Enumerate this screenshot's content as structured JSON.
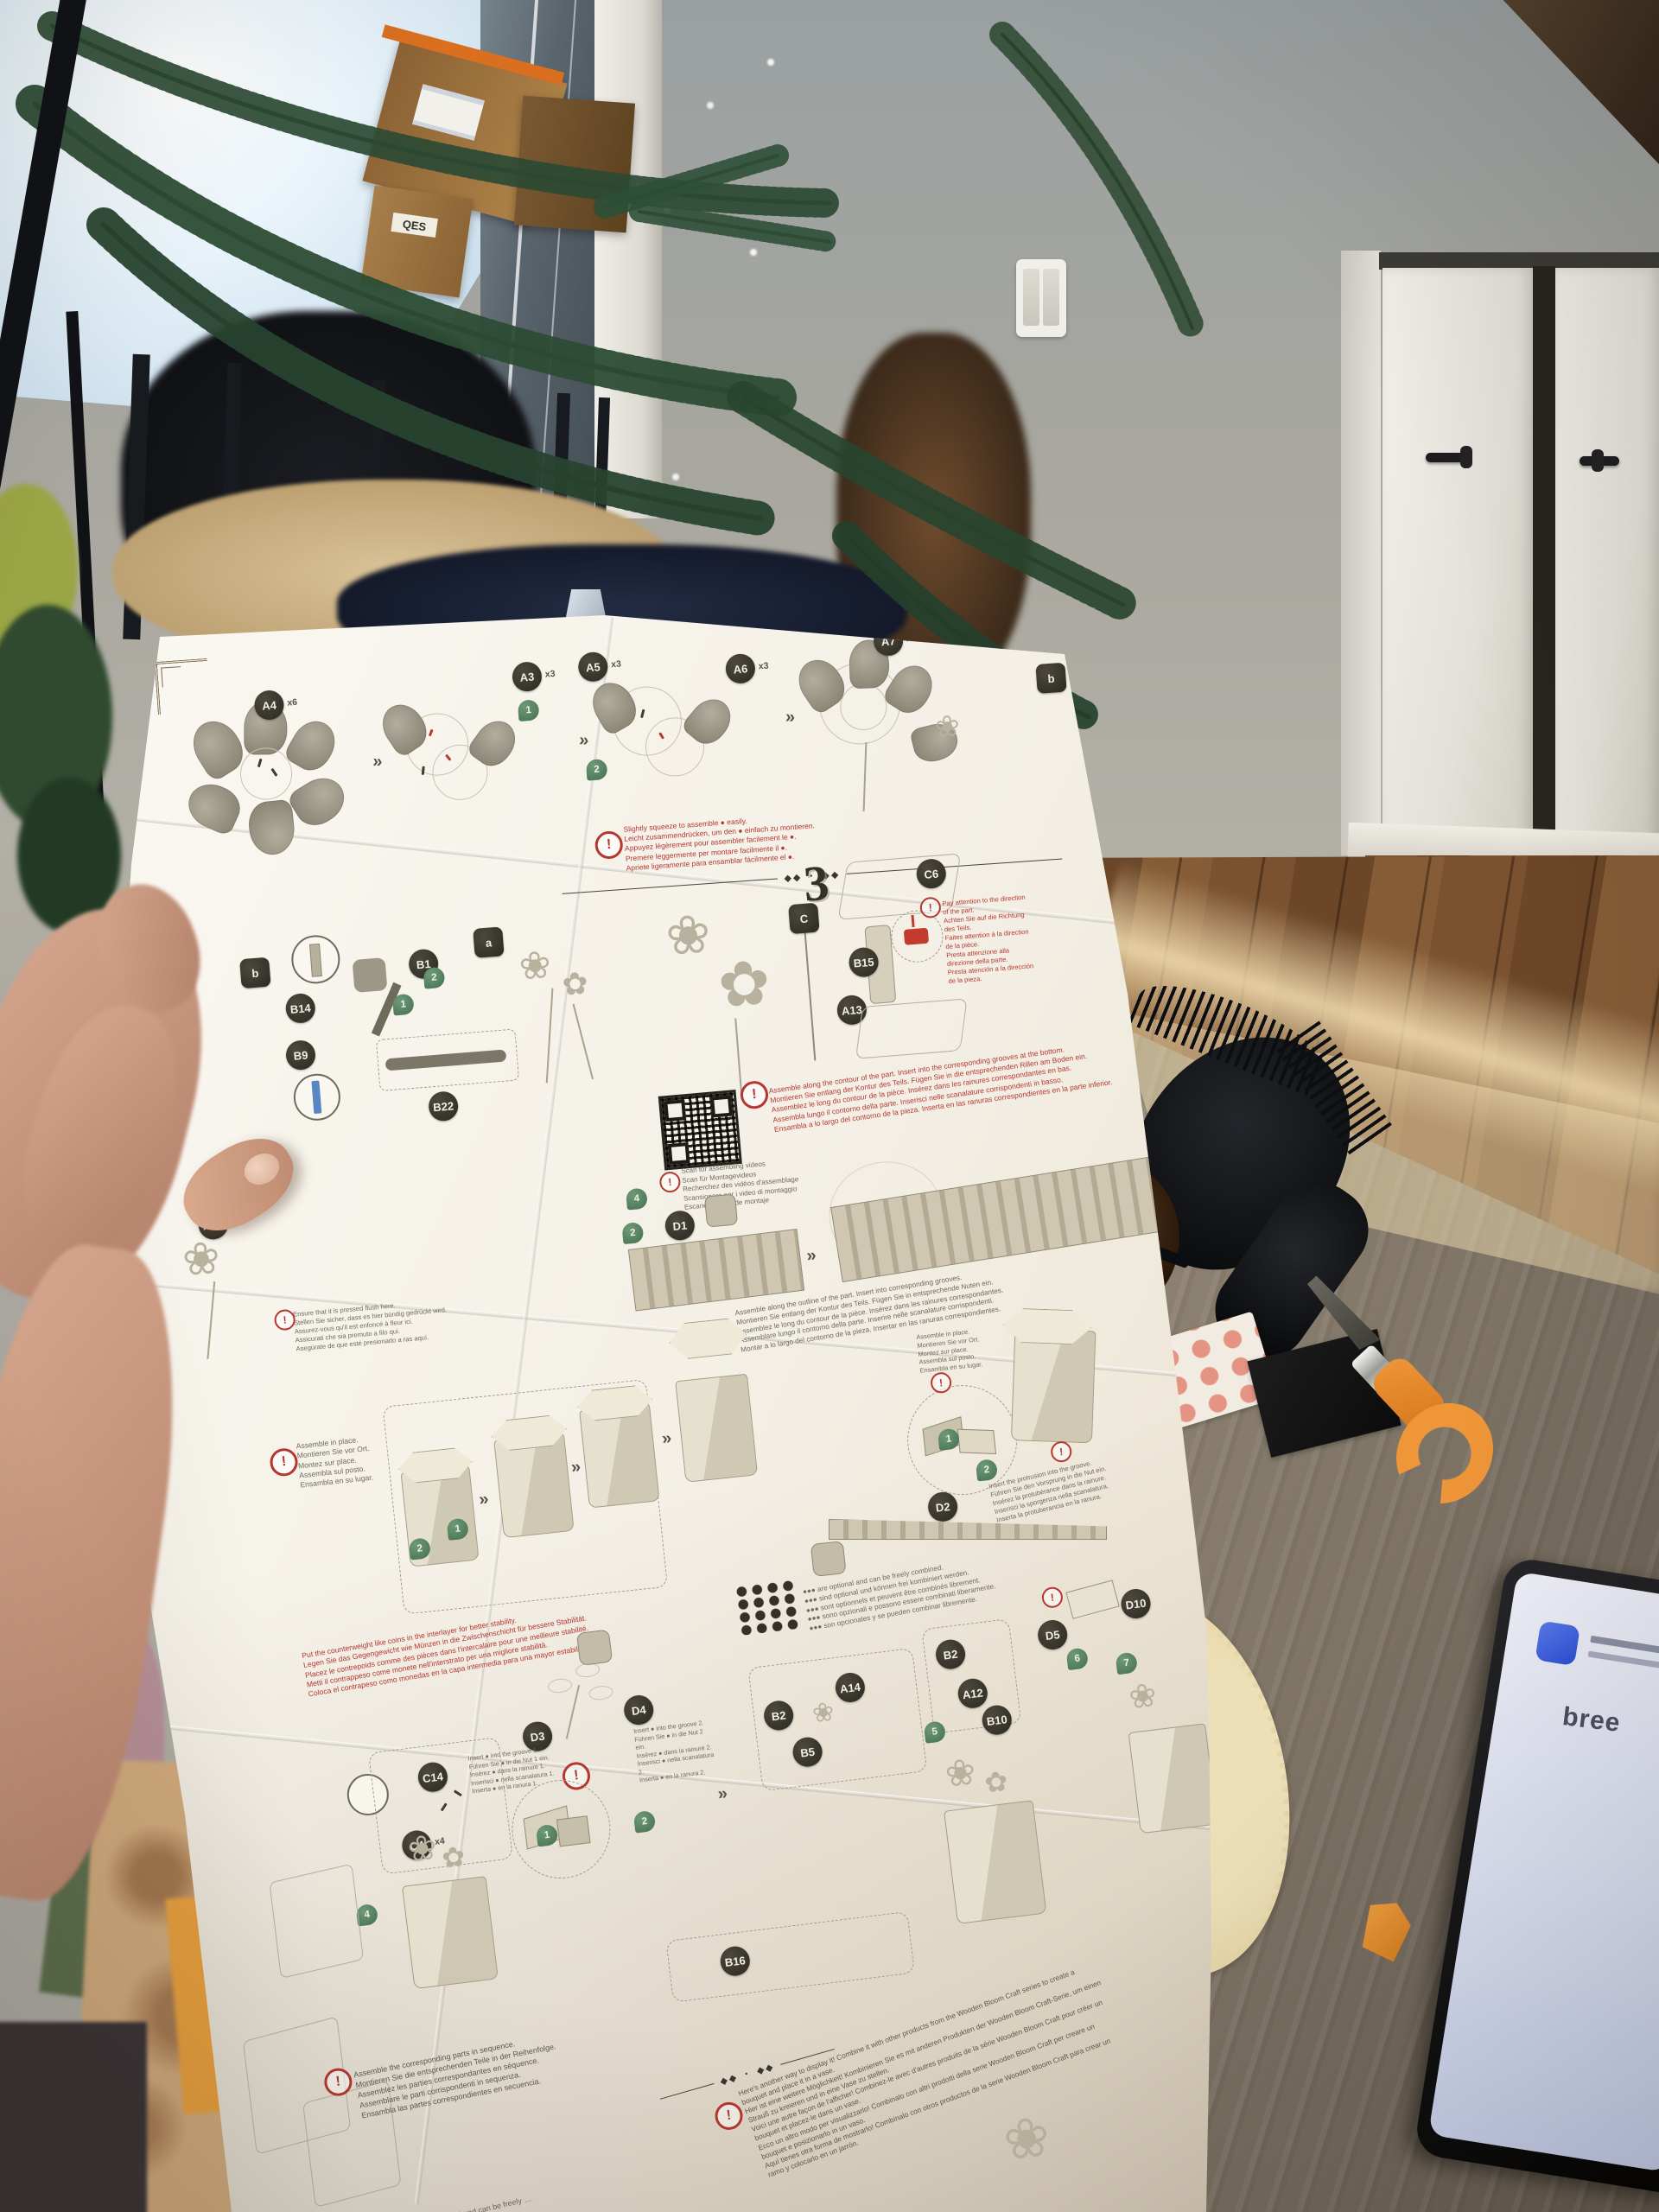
{
  "sheet": {
    "warning_mark": "!",
    "arrow_glyph": "»",
    "divider_glyph": "◆◆ ・ ◆◆",
    "flower_glyph": "❀",
    "flower_glyph2": "✿",
    "row1": {
      "badges": [
        {
          "id": "A4",
          "count": "x6"
        },
        {
          "id": "A3",
          "count": "x3"
        },
        {
          "id": "A5",
          "count": "x3"
        },
        {
          "id": "A6",
          "count": "x3"
        },
        {
          "id": "A7",
          "count": "x3"
        }
      ],
      "letter_badge": "b",
      "steps": [
        "1",
        "2"
      ],
      "warning": [
        "Slightly squeeze to assemble ● easily.",
        "Leicht zusammendrücken, um den ● einfach zu montieren.",
        "Appuyez légèrement pour assembler facilement le ●.",
        "Premere leggermente per montare facilmente il ●.",
        "Apriete ligeramente para ensamblar fácilmente el ●."
      ]
    },
    "row2": {
      "step_number": "3",
      "badges": [
        "b",
        "B14",
        "B9",
        "B1",
        "B22"
      ],
      "letter_a": "a",
      "letter_c": "C",
      "right_badges": [
        "C6",
        "B15",
        "A13"
      ],
      "steps": [
        "1",
        "2"
      ],
      "warning": [
        "Pay attention to the direction of the part.",
        "Achten Sie auf die Richtung des Teils.",
        "Faites attention à la direction de la pièce.",
        "Presta attenzione alla direzione della parte.",
        "Presta atención a la dirección de la pieza."
      ]
    },
    "row3": {
      "badge_a10": "A10",
      "badge_d1": "D1",
      "steps": [
        "4",
        "2"
      ],
      "qr_caption": [
        "Scan for assembling videos",
        "Scan für Montagevideos",
        "Recherchez des vidéos d'assemblage",
        "Scansionare per i video di montaggio",
        "Escanee videos de montaje"
      ],
      "warning": [
        "Assemble along the contour of the part. Insert into the corresponding grooves at the bottom.",
        "Montieren Sie entlang der Kontur des Teils. Fügen Sie in die entsprechenden Rillen am Boden ein.",
        "Assemblez le long du contour de la pièce. Insérez dans les rainures correspondantes en bas.",
        "Assembla lungo il contorno della parte. Inserisci nelle scanalature corrispondenti in basso.",
        "Ensambla a lo largo del contorno de la pieza. Inserta en las ranuras correspondientes en la parte inferior."
      ],
      "flush_note": [
        "Ensure that it is pressed flush here.",
        "Stellen Sie sicher, dass es hier bündig gedrückt wird.",
        "Assurez-vous qu'il est enfoncé à fleur ici.",
        "Assicurati che sia premuto a filo qui.",
        "Asegúrate de que esté presionado a ras aquí."
      ]
    },
    "row4": {
      "outline_note": [
        "Assemble along the outline of the part. Insert into corresponding grooves.",
        "Montieren Sie entlang der Kontur des Teils. Fügen Sie in entsprechende Nuten ein.",
        "Assemblez le long du contour de la pièce. Insérez dans les rainures correspondantes.",
        "Assemblare lungo il contorno della parte. Inserire nelle scanalature corrispondenti.",
        "Montar a lo largo del contorno de la pieza. Insertar en las ranuras correspondientes."
      ],
      "in_place_note": [
        "Assemble in place.",
        "Montieren Sie vor Ort.",
        "Montez sur place.",
        "Assembla sul posto.",
        "Ensambla en su lugar."
      ],
      "counterweight_warning": [
        "Put the counterweight like coins in the interlayer for better stability.",
        "Legen Sie das Gegengewicht wie Münzen in die Zwischenschicht für bessere Stabilität.",
        "Placez le contrepoids comme des pièces dans l'intercalaire pour une meilleure stabilité.",
        "Metti il contrappeso come monete nell'interstrato per una migliore stabilità.",
        "Coloca el contrapeso como monedas en la capa intermedia para una mayor estabilidad."
      ],
      "protrusion_note": [
        "Insert the protrusion into the groove.",
        "Führen Sie den Vorsprung in die Nut ein.",
        "Insérez la protubérance dans la rainure.",
        "Inserisci la sporgenza nella scanalatura.",
        "Inserta la protuberancia en la ranura."
      ],
      "badge_d2": "D2",
      "steps": [
        "1",
        "2"
      ]
    },
    "row5": {
      "optional_note": [
        "●●● are optional and can be freely combined.",
        "●●● sind optional und können frei kombiniert werden.",
        "●●● sont optionnels et peuvent être combinés librement.",
        "●●● sono opzionali e possono essere combinati liberamente.",
        "●●● son opcionales y se pueden combinar libremente."
      ],
      "box1": [
        "B2",
        "A14",
        "B5"
      ],
      "box2": [
        "C14",
        "C4"
      ],
      "box2_count": "x4",
      "d_badges": [
        "D3",
        "D4",
        "D5",
        "D10"
      ],
      "box3": [
        "B2",
        "A12",
        "B10"
      ],
      "steps": [
        "4",
        "5",
        "6",
        "7"
      ],
      "detail_steps": [
        "1",
        "2"
      ],
      "insert_note_1": [
        "Insert ● into the groove 1.",
        "Führen Sie ● in die Nut 1 ein.",
        "Insérez ● dans la rainure 1.",
        "Inserisci ● nella scanalatura 1.",
        "Inserta ● en la ranura 1."
      ],
      "insert_note_2": [
        "Insert ● into the groove 2.",
        "Führen Sie ● in die Nut 2 ein.",
        "Insérez ● dans la rainure 2.",
        "Inserisci ● nella scanalatura 2.",
        "Inserta ● en la ranura 2."
      ]
    },
    "row6": {
      "badge_b16": "B16",
      "sequence_note": [
        "Assemble the corresponding parts in sequence.",
        "Montieren Sie die entsprechenden Teile in der Reihenfolge.",
        "Assemblez les parties correspondantes en séquence.",
        "Assemblare le parti corrispondenti in sequenza.",
        "Ensambla las partes correspondientes en secuencia."
      ],
      "display_note": [
        "Here's another way to display it! Combine it with other products from the Wooden Bloom Craft series to create a bouquet and place it in a vase.",
        "Hier ist eine weitere Möglichkeit! Kombinieren Sie es mit anderen Produkten der Wooden Bloom Craft-Serie, um einen Strauß zu kreieren und in eine Vase zu stellen.",
        "Voici une autre façon de l'afficher! Combinez-le avec d'autres produits de la série Wooden Bloom Craft pour créer un bouquet et placez-le dans un vase.",
        "Ecco un altro modo per visualizzarlo! Combinalo con altri prodotti della serie Wooden Bloom Craft per creare un bouquet e posizionarlo in un vaso.",
        "Aquí tienes otra forma de mostrarlo! Combínalo con otros productos de la serie Wooden Bloom Craft para crear un ramo y colocarlo en un jarrón."
      ],
      "back_note": "Messages can be written on the back  ●●◐  are optional and can be freely …"
    }
  },
  "box_label": "QES",
  "phone": {
    "app_text": "bree"
  },
  "colors": {
    "accent_red": "#b5372f",
    "step_green": "#4e7d5b",
    "badge_dark": "#2c2921",
    "knife_orange": "#ef9638",
    "phone_blue": "#2b4fd8",
    "sheet_white": "#f5f1e7",
    "table_wood": "#8d8272",
    "floor_wood": "#7a5230"
  }
}
